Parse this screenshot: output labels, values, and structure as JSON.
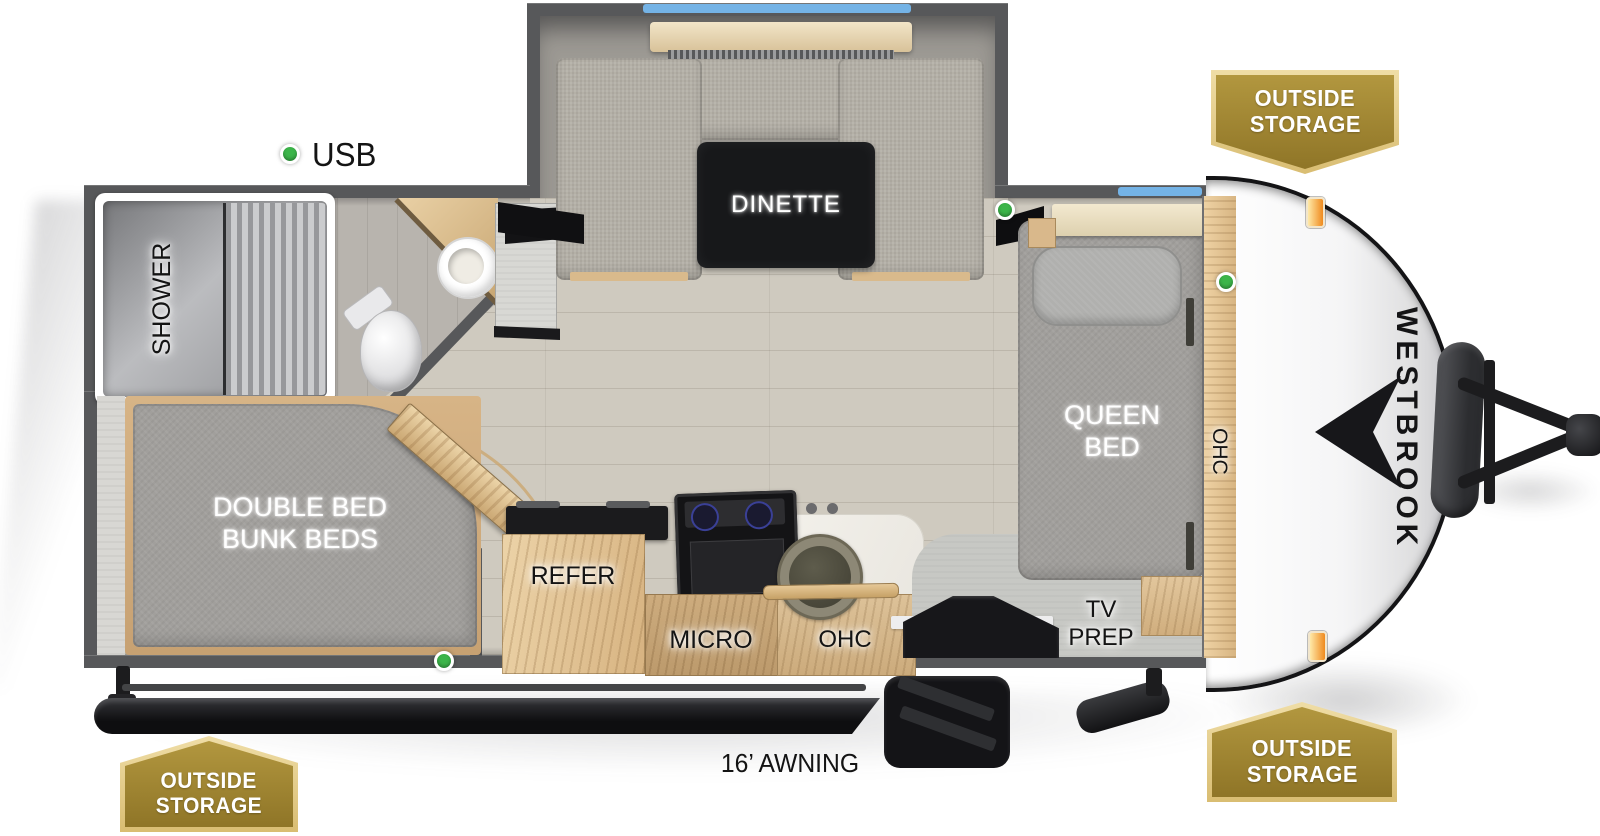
{
  "meta": {
    "title": "Westbrook travel trailer floor plan"
  },
  "brand": {
    "name": "WESTBROOK"
  },
  "exterior": {
    "awning_label": "16’ AWNING",
    "badges": [
      {
        "position": "top-right",
        "line1": "OUTSIDE",
        "line2": "STORAGE"
      },
      {
        "position": "bottom-right",
        "line1": "OUTSIDE",
        "line2": "STORAGE"
      },
      {
        "position": "bottom-left",
        "line1": "OUTSIDE",
        "line2": "STORAGE"
      }
    ]
  },
  "interior": {
    "usb_label": "USB",
    "dinette": {
      "table_label": "DINETTE"
    },
    "bathroom": {
      "shower_label": "SHOWER"
    },
    "bedroom": {
      "bed_line1": "QUEEN",
      "bed_line2": "BED",
      "overhead_cabinet": "OHC",
      "tv_line1": "TV",
      "tv_line2": "PREP"
    },
    "bunkroom": {
      "bed_line1": "DOUBLE BED",
      "bed_line2": "BUNK BEDS"
    },
    "kitchen": {
      "refrigerator": "REFER",
      "microwave": "MICRO",
      "overhead_cabinet": "OHC"
    }
  },
  "colors": {
    "wall_gray": "#57585a",
    "window_blue": "#74b3e6",
    "led_green": "#3cb54a",
    "badge_gold": "#b2973f",
    "badge_gold_dark": "#8f7527",
    "badge_border": "#d9bd72",
    "marker_orange": "#ef8a1e",
    "table_black": "#17181a"
  }
}
